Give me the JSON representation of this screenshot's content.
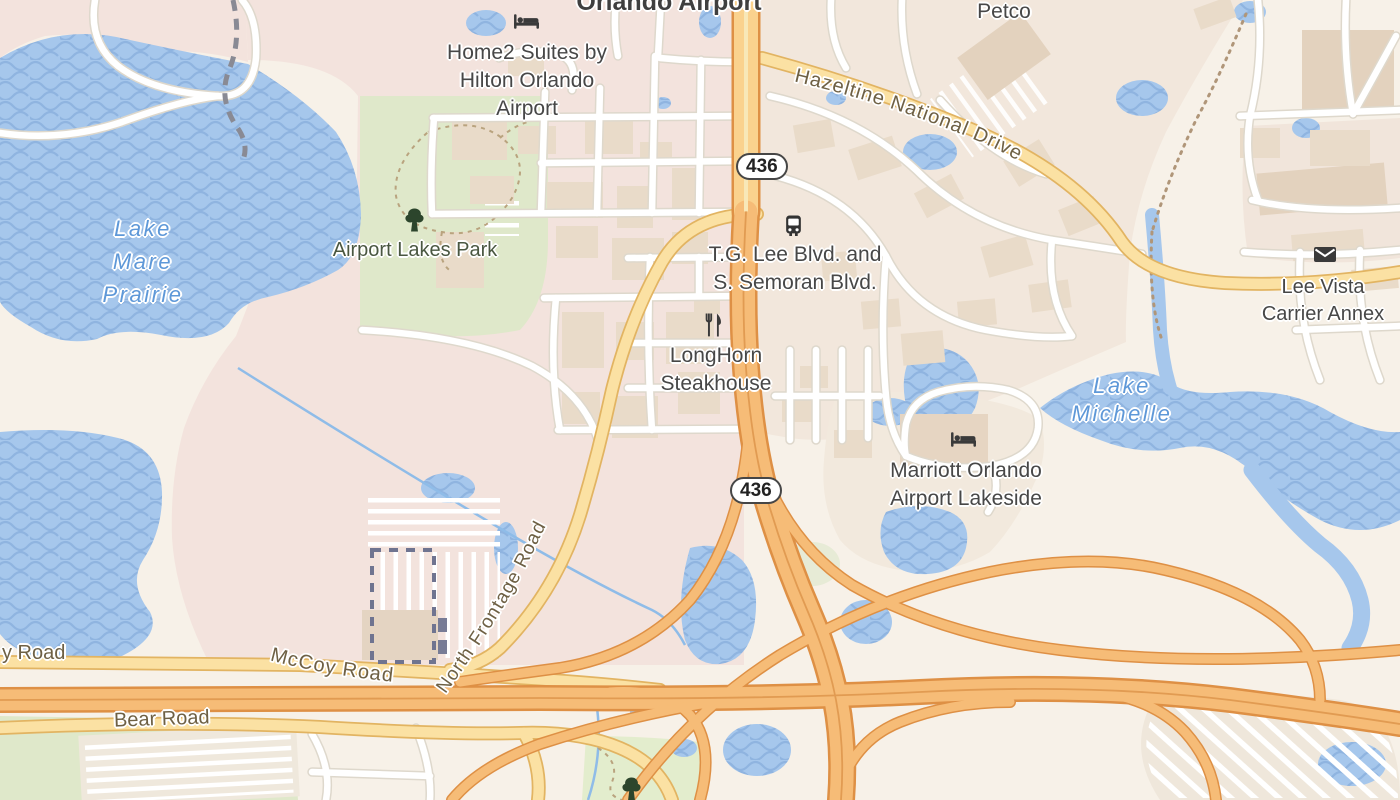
{
  "city_label": "Orlando Airport",
  "pois": [
    {
      "id": "home2-suites",
      "icon": "bed-icon",
      "lines": [
        "Home2 Suites by",
        "Hilton Orlando",
        "Airport"
      ]
    },
    {
      "id": "petco",
      "icon": null,
      "lines": [
        "Petco"
      ]
    },
    {
      "id": "tg-lee-bus-stop",
      "icon": "bus-icon",
      "lines": [
        "T.G. Lee Blvd. and",
        "S. Semoran Blvd."
      ]
    },
    {
      "id": "longhorn-steakhouse",
      "icon": "restaurant-icon",
      "lines": [
        "LongHorn",
        "Steakhouse"
      ]
    },
    {
      "id": "lee-vista-carrier-annex",
      "icon": "mail-icon",
      "lines": [
        "Lee Vista",
        "Carrier Annex"
      ]
    },
    {
      "id": "marriott-lakeside",
      "icon": "bed-icon",
      "lines": [
        "Marriott Orlando",
        "Airport Lakeside"
      ]
    }
  ],
  "parks": [
    {
      "name": "Airport Lakes Park",
      "icon": "tree-icon"
    }
  ],
  "water_labels": [
    {
      "id": "lake-mare-prairie",
      "lines": [
        "Lake",
        "Mare",
        "Prairie"
      ]
    },
    {
      "id": "lake-michelle",
      "lines": [
        "Lake",
        "Michelle"
      ]
    }
  ],
  "road_labels": {
    "hazeltine": "Hazeltine National Drive",
    "mccoy": "McCoy Road",
    "bear": "Bear Road",
    "north_frontage": "North Frontage Road",
    "partial_left": "y Road"
  },
  "shields": [
    {
      "text": "436"
    },
    {
      "text": "436"
    }
  ],
  "colors": {
    "land": "#F7F1E8",
    "builtup_pink": "#F3E3DD",
    "park_green": "#DFE8CA",
    "water_blue": "#A6C7EC",
    "wave_blue": "#8FB4E0",
    "water_label_blue": "#5E98D8",
    "secondary_road": "#FBE1A3",
    "trunk_road": "#F6BC77",
    "trunk_casing": "#DE9045",
    "road_label_brown": "#6E6044",
    "poi_label_gray": "#474747"
  }
}
